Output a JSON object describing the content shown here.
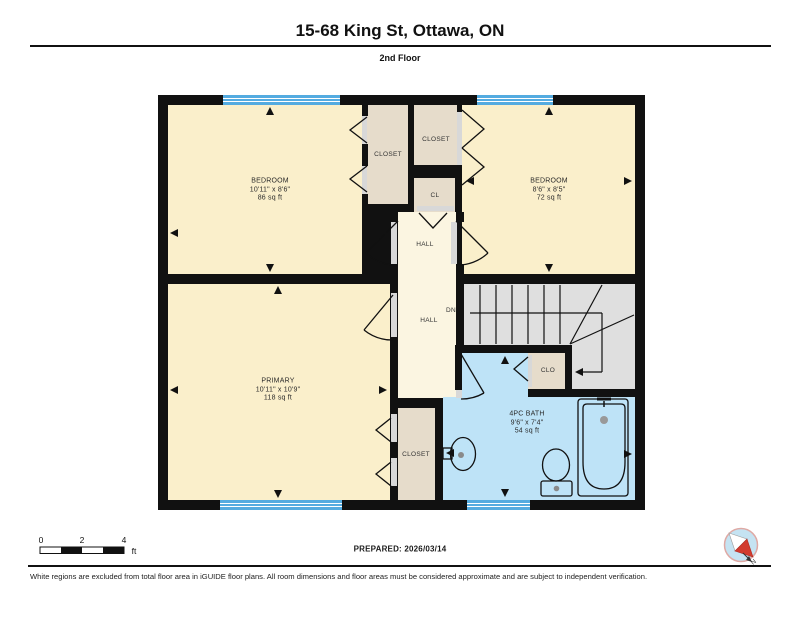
{
  "header": {
    "title": "15-68 King St, Ottawa, ON",
    "floor": "2nd Floor"
  },
  "rooms": {
    "bedroom1": {
      "name": "BEDROOM",
      "dims": "10'11\" x 8'6\"",
      "area": "86 sq ft"
    },
    "bedroom2": {
      "name": "BEDROOM",
      "dims": "8'6\" x 8'5\"",
      "area": "72 sq ft"
    },
    "primary": {
      "name": "PRIMARY",
      "dims": "10'11\" x 10'9\"",
      "area": "118 sq ft"
    },
    "bath": {
      "name": "4PC BATH",
      "dims": "9'6\" x 7'4\"",
      "area": "54 sq ft"
    },
    "closet1": {
      "name": "CLOSET"
    },
    "closet2": {
      "name": "CLOSET"
    },
    "cl": {
      "name": "CL"
    },
    "hall_upper": {
      "name": "HALL"
    },
    "hall_lower": {
      "name": "HALL"
    },
    "dn": {
      "name": "DN"
    },
    "clo": {
      "name": "CLO"
    },
    "closet3": {
      "name": "CLOSET"
    }
  },
  "scale": {
    "ticks": [
      "0",
      "2",
      "4"
    ],
    "unit": "ft"
  },
  "footer": {
    "prepared": "PREPARED: 2026/03/14",
    "disclaimer": "White regions are excluded from total floor area in iGUIDE floor plans. All room dimensions and floor areas must be considered approximate and are subject to independent verification."
  },
  "compass": {
    "label": "N"
  },
  "colors": {
    "room": "#FAEFCB",
    "hall": "#FBF5E1",
    "closet": "#E6DCCB",
    "bath": "#BEE3F7",
    "stairs": "#DFDFDF",
    "window": "#54ABE0",
    "wall": "#111111",
    "compass_needle": "#D23B2E"
  }
}
